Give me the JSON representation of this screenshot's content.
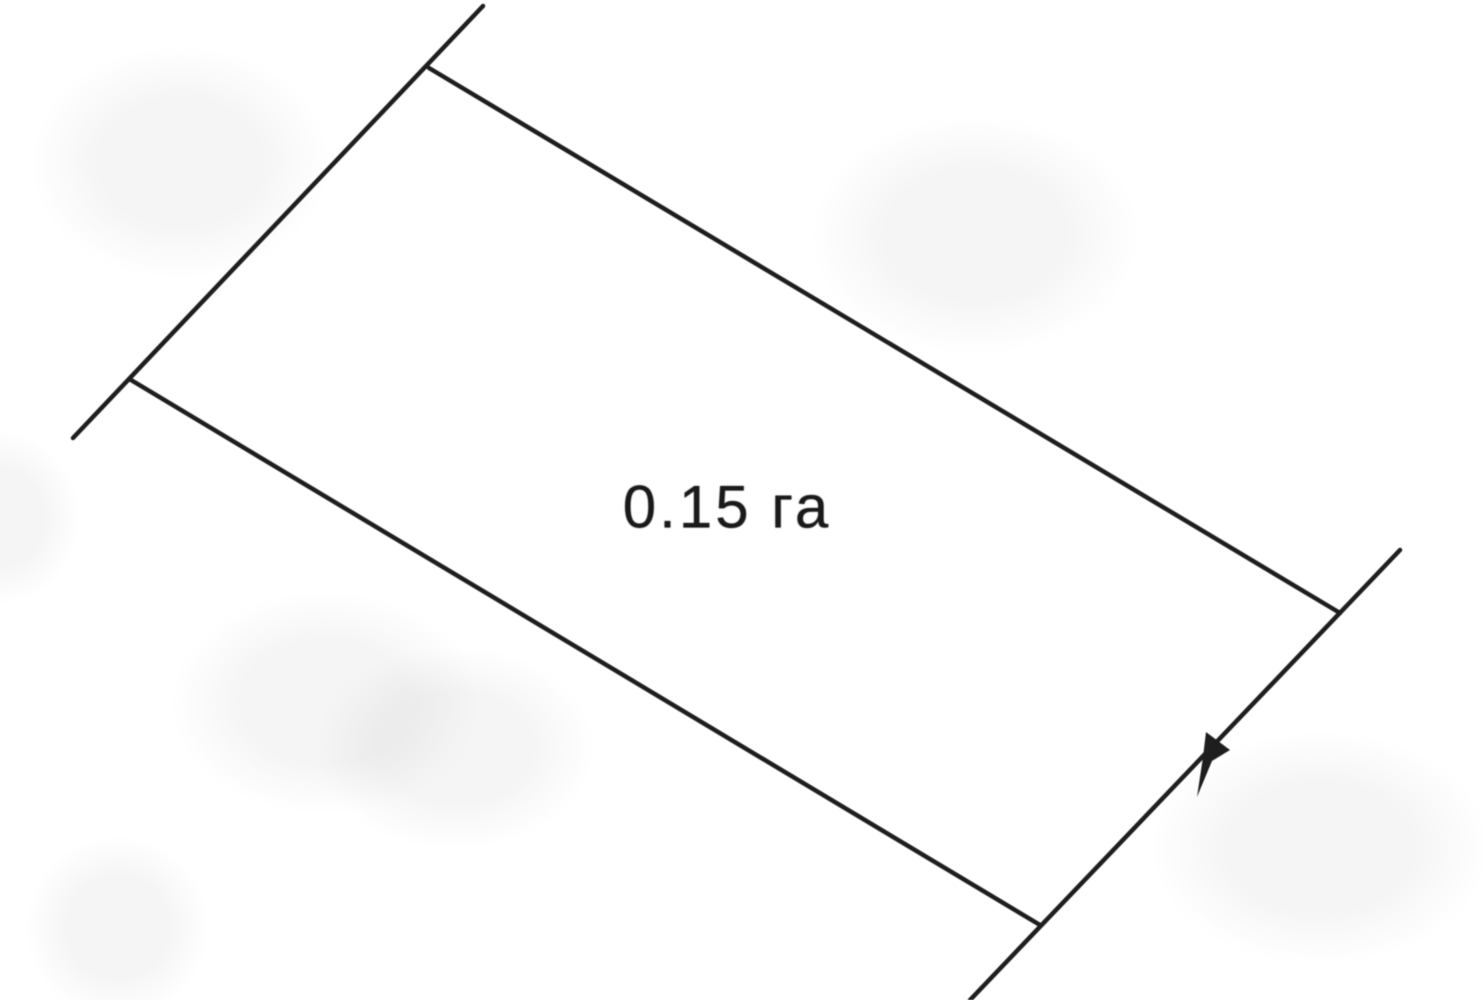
{
  "page": {
    "background_color": "#ffffff"
  },
  "diagram": {
    "type": "land-plot-boundary-sketch",
    "area_label": "0.15 га",
    "line_color": "#1e1e1e",
    "label_color": "#1a1a1a",
    "label_position": {
      "x": 727,
      "y": 507
    },
    "boundary_lines": [
      {
        "name": "left-boundary-line",
        "x1": 483,
        "y1": 6,
        "x2": 73,
        "y2": 438
      },
      {
        "name": "top-boundary-line",
        "x1": 429,
        "y1": 68,
        "x2": 1340,
        "y2": 613
      },
      {
        "name": "bottom-boundary-line",
        "x1": 131,
        "y1": 380,
        "x2": 1040,
        "y2": 925
      },
      {
        "name": "right-boundary-line",
        "x1": 1400,
        "y1": 550,
        "x2": 970,
        "y2": 1000
      }
    ],
    "direction_marker": {
      "points": "1206,732 1230,750 1212,761 1197,797 1203,757"
    }
  }
}
